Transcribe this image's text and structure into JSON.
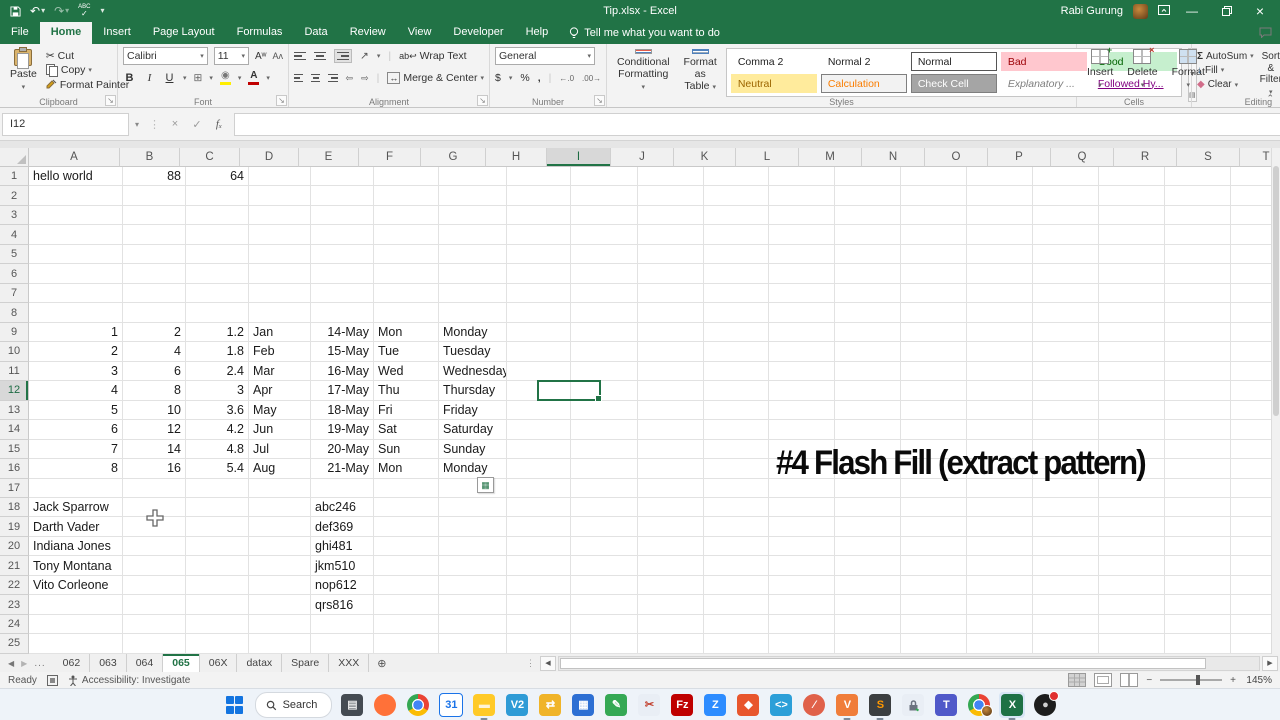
{
  "title_bar": {
    "title": "Tip.xlsx - Excel",
    "user": "Rabi Gurung",
    "qat": {
      "save": "Save",
      "undo": "Undo",
      "redo": "Redo",
      "spelling": "ABC",
      "customize": "Customize Quick Access Toolbar"
    },
    "window": {
      "minimize": "Minimize",
      "restore": "Restore",
      "close": "Close"
    }
  },
  "ribbon": {
    "tabs": [
      {
        "label": "File",
        "file": true
      },
      {
        "label": "Home",
        "active": true
      },
      {
        "label": "Insert"
      },
      {
        "label": "Page Layout"
      },
      {
        "label": "Formulas"
      },
      {
        "label": "Data"
      },
      {
        "label": "Review"
      },
      {
        "label": "View"
      },
      {
        "label": "Developer"
      },
      {
        "label": "Help"
      }
    ],
    "tell_me": "Tell me what you want to do",
    "groups": {
      "clipboard": {
        "label": "Clipboard",
        "paste": "Paste",
        "cut": "Cut",
        "copy": "Copy",
        "painter": "Format Painter"
      },
      "font": {
        "label": "Font",
        "name": "Calibri",
        "size": "11"
      },
      "alignment": {
        "label": "Alignment",
        "wrap": "Wrap Text",
        "merge": "Merge & Center"
      },
      "number": {
        "label": "Number",
        "format": "General"
      },
      "styles": {
        "label": "Styles",
        "cf1": "Conditional",
        "cf2": "Formatting",
        "fat1": "Format as",
        "fat2": "Table",
        "gallery": [
          {
            "t": "Comma 2"
          },
          {
            "t": "Normal 2"
          },
          {
            "t": "Normal",
            "sel": true
          },
          {
            "t": "Bad",
            "bg": "#ffc7ce",
            "fg": "#9c0006"
          },
          {
            "t": "Good",
            "bg": "#c6efce",
            "fg": "#006100"
          },
          {
            "t": "Neutral",
            "bg": "#ffeb9c",
            "fg": "#9c6500"
          },
          {
            "t": "Calculation",
            "bg": "#f2f2f2",
            "fg": "#fa7d00",
            "bd": true
          },
          {
            "t": "Check Cell",
            "bg": "#a5a5a5",
            "fg": "#ffffff",
            "bd": true
          },
          {
            "t": "Explanatory ...",
            "fg": "#7f7f7f",
            "it": true
          },
          {
            "t": "Followed Hy...",
            "fg": "#800080",
            "ul": true
          }
        ]
      },
      "cells": {
        "label": "Cells",
        "items": [
          {
            "t": "Insert"
          },
          {
            "t": "Delete"
          },
          {
            "t": "Format"
          }
        ]
      },
      "editing": {
        "label": "Editing",
        "autosum": "AutoSum",
        "fill": "Fill",
        "clear": "Clear",
        "sort1": "Sort &",
        "sort2": "Filter",
        "find1": "Find &",
        "find2": "Select"
      }
    }
  },
  "formula_bar": {
    "name_box": "I12",
    "formula": ""
  },
  "grid": {
    "columns": [
      "A",
      "B",
      "C",
      "D",
      "E",
      "F",
      "G",
      "H",
      "I",
      "J",
      "K",
      "L",
      "M",
      "N",
      "O",
      "P",
      "Q",
      "R",
      "S",
      "T"
    ],
    "row_count": 25,
    "selection": {
      "ref": "I12",
      "col": "I",
      "row": 12
    },
    "overlay_text": "#4 Flash Fill (extract pattern)",
    "cells": [
      {
        "r": 1,
        "c": "A",
        "v": "hello world",
        "a": "l"
      },
      {
        "r": 1,
        "c": "B",
        "v": "88",
        "a": "r"
      },
      {
        "r": 1,
        "c": "C",
        "v": "64",
        "a": "r"
      },
      {
        "r": 9,
        "c": "A",
        "v": "1",
        "a": "r"
      },
      {
        "r": 9,
        "c": "B",
        "v": "2",
        "a": "r"
      },
      {
        "r": 9,
        "c": "C",
        "v": "1.2",
        "a": "r"
      },
      {
        "r": 9,
        "c": "D",
        "v": "Jan",
        "a": "l"
      },
      {
        "r": 9,
        "c": "E",
        "v": "14-May",
        "a": "r"
      },
      {
        "r": 9,
        "c": "F",
        "v": "Mon",
        "a": "l"
      },
      {
        "r": 9,
        "c": "G",
        "v": "Monday",
        "a": "l"
      },
      {
        "r": 10,
        "c": "A",
        "v": "2",
        "a": "r"
      },
      {
        "r": 10,
        "c": "B",
        "v": "4",
        "a": "r"
      },
      {
        "r": 10,
        "c": "C",
        "v": "1.8",
        "a": "r"
      },
      {
        "r": 10,
        "c": "D",
        "v": "Feb",
        "a": "l"
      },
      {
        "r": 10,
        "c": "E",
        "v": "15-May",
        "a": "r"
      },
      {
        "r": 10,
        "c": "F",
        "v": "Tue",
        "a": "l"
      },
      {
        "r": 10,
        "c": "G",
        "v": "Tuesday",
        "a": "l"
      },
      {
        "r": 11,
        "c": "A",
        "v": "3",
        "a": "r"
      },
      {
        "r": 11,
        "c": "B",
        "v": "6",
        "a": "r"
      },
      {
        "r": 11,
        "c": "C",
        "v": "2.4",
        "a": "r"
      },
      {
        "r": 11,
        "c": "D",
        "v": "Mar",
        "a": "l"
      },
      {
        "r": 11,
        "c": "E",
        "v": "16-May",
        "a": "r"
      },
      {
        "r": 11,
        "c": "F",
        "v": "Wed",
        "a": "l"
      },
      {
        "r": 11,
        "c": "G",
        "v": "Wednesday",
        "a": "l"
      },
      {
        "r": 12,
        "c": "A",
        "v": "4",
        "a": "r"
      },
      {
        "r": 12,
        "c": "B",
        "v": "8",
        "a": "r"
      },
      {
        "r": 12,
        "c": "C",
        "v": "3",
        "a": "r"
      },
      {
        "r": 12,
        "c": "D",
        "v": "Apr",
        "a": "l"
      },
      {
        "r": 12,
        "c": "E",
        "v": "17-May",
        "a": "r"
      },
      {
        "r": 12,
        "c": "F",
        "v": "Thu",
        "a": "l"
      },
      {
        "r": 12,
        "c": "G",
        "v": "Thursday",
        "a": "l"
      },
      {
        "r": 13,
        "c": "A",
        "v": "5",
        "a": "r"
      },
      {
        "r": 13,
        "c": "B",
        "v": "10",
        "a": "r"
      },
      {
        "r": 13,
        "c": "C",
        "v": "3.6",
        "a": "r"
      },
      {
        "r": 13,
        "c": "D",
        "v": "May",
        "a": "l"
      },
      {
        "r": 13,
        "c": "E",
        "v": "18-May",
        "a": "r"
      },
      {
        "r": 13,
        "c": "F",
        "v": "Fri",
        "a": "l"
      },
      {
        "r": 13,
        "c": "G",
        "v": "Friday",
        "a": "l"
      },
      {
        "r": 14,
        "c": "A",
        "v": "6",
        "a": "r"
      },
      {
        "r": 14,
        "c": "B",
        "v": "12",
        "a": "r"
      },
      {
        "r": 14,
        "c": "C",
        "v": "4.2",
        "a": "r"
      },
      {
        "r": 14,
        "c": "D",
        "v": "Jun",
        "a": "l"
      },
      {
        "r": 14,
        "c": "E",
        "v": "19-May",
        "a": "r"
      },
      {
        "r": 14,
        "c": "F",
        "v": "Sat",
        "a": "l"
      },
      {
        "r": 14,
        "c": "G",
        "v": "Saturday",
        "a": "l"
      },
      {
        "r": 15,
        "c": "A",
        "v": "7",
        "a": "r"
      },
      {
        "r": 15,
        "c": "B",
        "v": "14",
        "a": "r"
      },
      {
        "r": 15,
        "c": "C",
        "v": "4.8",
        "a": "r"
      },
      {
        "r": 15,
        "c": "D",
        "v": "Jul",
        "a": "l"
      },
      {
        "r": 15,
        "c": "E",
        "v": "20-May",
        "a": "r"
      },
      {
        "r": 15,
        "c": "F",
        "v": "Sun",
        "a": "l"
      },
      {
        "r": 15,
        "c": "G",
        "v": "Sunday",
        "a": "l"
      },
      {
        "r": 16,
        "c": "A",
        "v": "8",
        "a": "r"
      },
      {
        "r": 16,
        "c": "B",
        "v": "16",
        "a": "r"
      },
      {
        "r": 16,
        "c": "C",
        "v": "5.4",
        "a": "r"
      },
      {
        "r": 16,
        "c": "D",
        "v": "Aug",
        "a": "l"
      },
      {
        "r": 16,
        "c": "E",
        "v": "21-May",
        "a": "r"
      },
      {
        "r": 16,
        "c": "F",
        "v": "Mon",
        "a": "l"
      },
      {
        "r": 16,
        "c": "G",
        "v": "Monday",
        "a": "l"
      },
      {
        "r": 18,
        "c": "A",
        "v": "Jack Sparrow",
        "a": "l"
      },
      {
        "r": 18,
        "c": "E",
        "v": "abc246",
        "a": "l"
      },
      {
        "r": 19,
        "c": "A",
        "v": "Darth Vader",
        "a": "l"
      },
      {
        "r": 19,
        "c": "E",
        "v": "def369",
        "a": "l"
      },
      {
        "r": 20,
        "c": "A",
        "v": "Indiana Jones",
        "a": "l"
      },
      {
        "r": 20,
        "c": "E",
        "v": "ghi481",
        "a": "l"
      },
      {
        "r": 21,
        "c": "A",
        "v": "Tony Montana",
        "a": "l"
      },
      {
        "r": 21,
        "c": "E",
        "v": "jkm510",
        "a": "l"
      },
      {
        "r": 22,
        "c": "A",
        "v": "Vito Corleone",
        "a": "l"
      },
      {
        "r": 22,
        "c": "E",
        "v": "nop612",
        "a": "l"
      },
      {
        "r": 23,
        "c": "E",
        "v": "qrs816",
        "a": "l"
      }
    ]
  },
  "sheet_tabs": {
    "overflow": "...",
    "tabs": [
      {
        "t": "062"
      },
      {
        "t": "063"
      },
      {
        "t": "064"
      },
      {
        "t": "065",
        "active": true
      },
      {
        "t": "06X"
      },
      {
        "t": "datax"
      },
      {
        "t": "Spare"
      },
      {
        "t": "XXX"
      }
    ]
  },
  "status_bar": {
    "mode": "Ready",
    "accessibility": "Accessibility: Investigate",
    "zoom": "145%"
  },
  "taskbar": {
    "search_placeholder": "Search",
    "icons": [
      {
        "name": "task-view-icon",
        "glyph": "▤",
        "bg": "#454b52",
        "fg": "#e8e8e8"
      },
      {
        "name": "firefox-icon",
        "glyph": "",
        "bg": "#ff7139",
        "fg": "#fff",
        "shape": "circle"
      },
      {
        "name": "chrome-icon",
        "shape": "chrome"
      },
      {
        "name": "calendar-icon",
        "glyph": "31",
        "bg": "#ffffff",
        "fg": "#1a73e8",
        "border": "#1a73e8"
      },
      {
        "name": "file-explorer-icon",
        "glyph": "▬",
        "bg": "#ffca28",
        "fg": "#fff3d6",
        "open": true
      },
      {
        "name": "vnc-viewer-icon",
        "glyph": "V2",
        "bg": "#2e9bd6",
        "fg": "#ffffff"
      },
      {
        "name": "powertoys-icon",
        "glyph": "⇄",
        "bg": "#f0b429",
        "fg": "#ffffff"
      },
      {
        "name": "calculator-icon",
        "glyph": "▦",
        "bg": "#2d6fd3",
        "fg": "#ffffff"
      },
      {
        "name": "editor-icon",
        "glyph": "✎",
        "bg": "#35a854",
        "fg": "#ffffff"
      },
      {
        "name": "snipping-tool-icon",
        "glyph": "✂",
        "bg": "#e9eef5",
        "fg": "#c2402e"
      },
      {
        "name": "filezilla-icon",
        "glyph": "Fz",
        "bg": "#bf0000",
        "fg": "#ffffff"
      },
      {
        "name": "zoom-app-icon",
        "glyph": "Z",
        "bg": "#2d8cff",
        "fg": "#ffffff"
      },
      {
        "name": "orange-app-icon",
        "glyph": "◆",
        "bg": "#e8562d",
        "fg": "#ffffff"
      },
      {
        "name": "vscode-icon",
        "glyph": "<>",
        "bg": "#2c9fd8",
        "fg": "#ffffff"
      },
      {
        "name": "blocked-app-icon",
        "glyph": "⁄",
        "bg": "#e0614a",
        "fg": "#ffffff",
        "shape": "circle"
      },
      {
        "name": "v-app-icon",
        "glyph": "V",
        "bg": "#f07d3a",
        "fg": "#ffffff",
        "open": true
      },
      {
        "name": "sublime-text-icon",
        "glyph": "S",
        "bg": "#3c3f41",
        "fg": "#ff9800",
        "open": true
      },
      {
        "name": "vpn-lock-icon",
        "glyph": "lock",
        "bg": "#e9eef5",
        "fg": "#445"
      },
      {
        "name": "teams-icon",
        "glyph": "T",
        "bg": "#5059c9",
        "fg": "#ffffff"
      },
      {
        "name": "chrome-profile-icon",
        "shape": "chrome",
        "profile": true
      },
      {
        "name": "excel-icon",
        "glyph": "X",
        "bg": "#1e7145",
        "fg": "#ffffff",
        "open": true,
        "highlighted": true
      },
      {
        "name": "obs-icon",
        "glyph": "●",
        "bg": "#1d1d1d",
        "fg": "#cfcfcf",
        "shape": "circle",
        "record": true
      }
    ]
  }
}
